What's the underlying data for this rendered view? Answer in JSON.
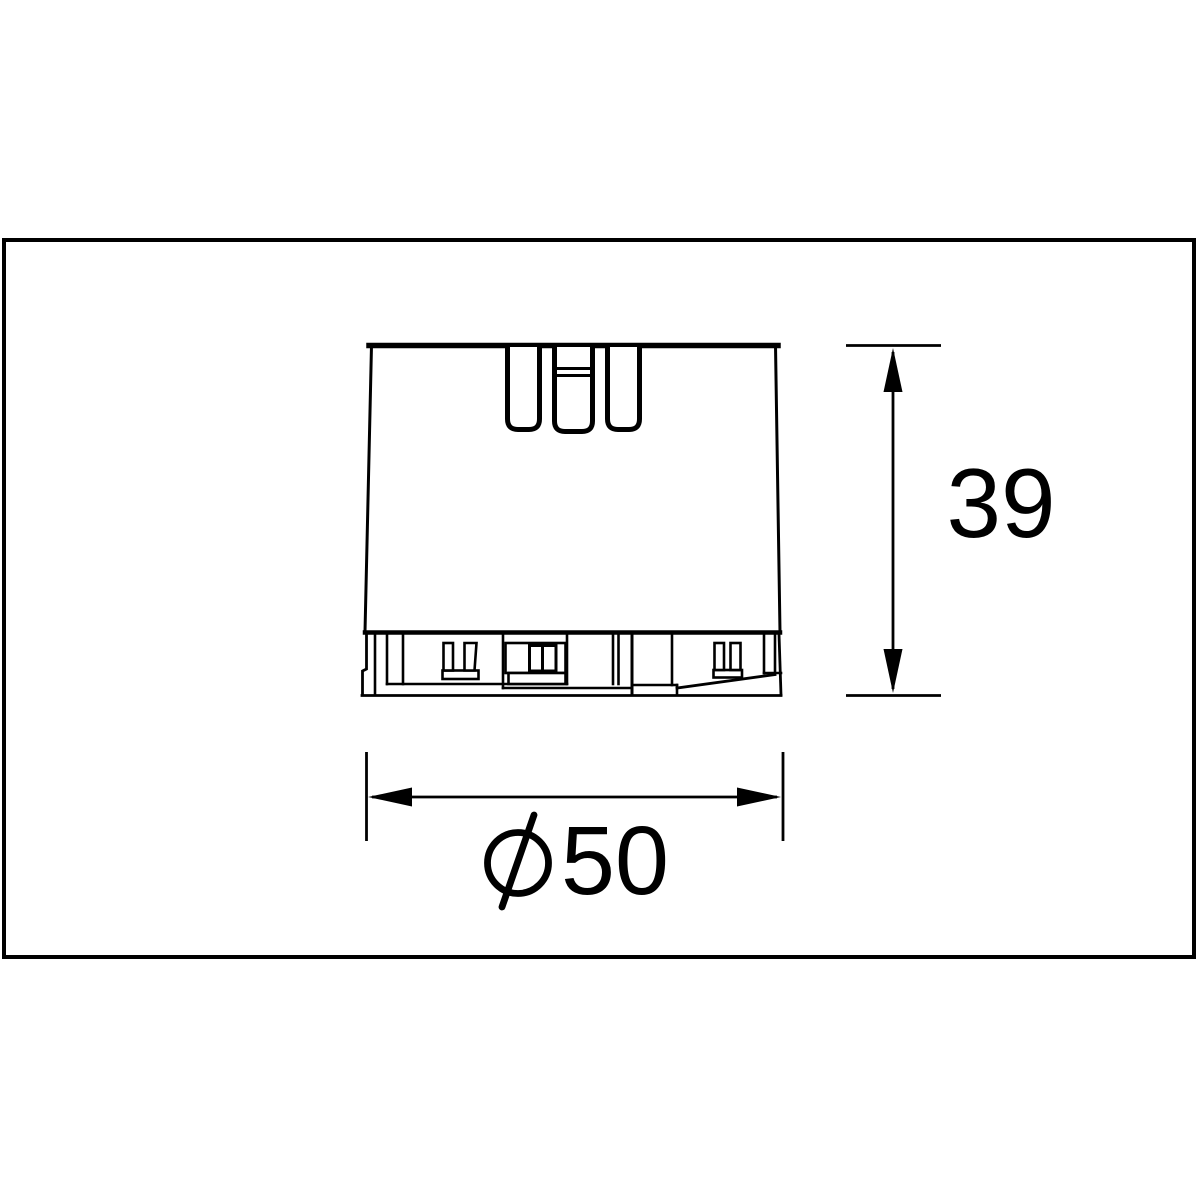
{
  "drawing": {
    "kind": "technical-dimension-drawing",
    "view": "front view of part with three top slots and mounting base",
    "background_color": "#ffffff",
    "line_color": "#000000"
  },
  "dimensions": {
    "height": {
      "label": "39",
      "value": 39,
      "orientation": "vertical"
    },
    "diameter": {
      "label": "⌀50",
      "number": "50",
      "value": 50,
      "orientation": "horizontal"
    }
  },
  "icons": {
    "diameter_symbol": "slashed-circle-diameter-icon",
    "arrows": "filled-triangle-dimension-arrows"
  }
}
